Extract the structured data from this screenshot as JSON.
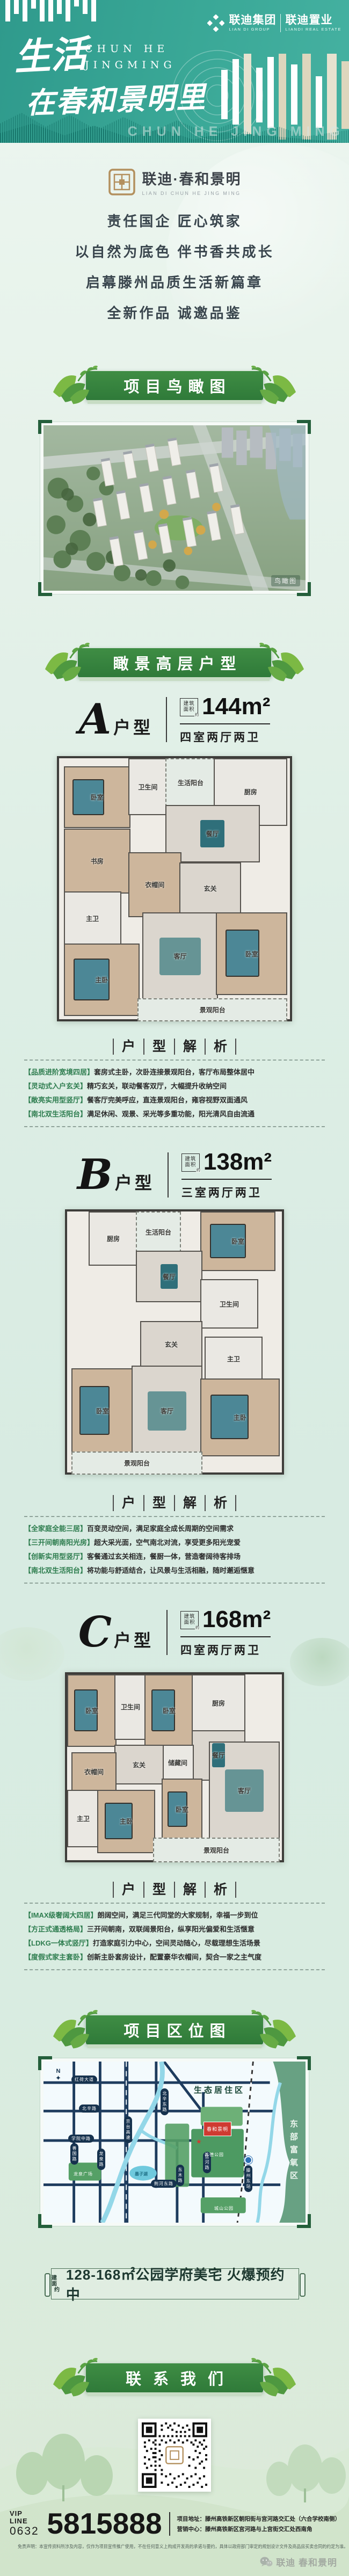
{
  "header": {
    "logo": {
      "group_cn": "联迪集团",
      "group_en": "LIAN DI GROUP",
      "estate_cn": "联迪置业",
      "estate_en": "LIANDI REAL ESTATE"
    },
    "title_line1": "生活",
    "title_line2": "在春和景明里",
    "subtitle_line1": "CHUN HE",
    "subtitle_line2": "JINGMING",
    "watermark": "CHUN HE JING MING"
  },
  "intro": {
    "brand_cn": "联迪·春和景明",
    "brand_en": "LIAN DI   CHUN HE JING MING",
    "line1": "责任国企 匠心筑家",
    "line2": "以自然为底色 伴书香共成长",
    "line3": "启幕滕州品质生活新篇章",
    "line4": "全新作品 诚邀品鉴"
  },
  "sections": {
    "aerial_banner": "项目鸟瞰图",
    "floorplan_banner": "瞰景高层户型",
    "location_banner": "项目区位图",
    "contact_banner": "联系我们"
  },
  "aerial": {
    "watermark": "鸟瞰图"
  },
  "analysis_title": [
    "户",
    "型",
    "解",
    "析"
  ],
  "units": [
    {
      "letter": "A",
      "suffix": "户型",
      "area_box": [
        "建筑",
        "面积"
      ],
      "area_approx": "约",
      "area": "144m²",
      "rooms": "四室两厅两卫",
      "analysis": [
        {
          "tag": "【品质进阶宽境四居】",
          "text": "套房式主卧，次卧连接景观阳台，客厅布局整体居中"
        },
        {
          "tag": "【灵动式入户玄关】",
          "text": "精巧玄关，联动餐客双厅，大幅提升收纳空间"
        },
        {
          "tag": "【敞亮实用型竖厅】",
          "text": "餐客厅完美呼应，直连景观阳台，雍容视野双面通风"
        },
        {
          "tag": "【南北双生活阳台】",
          "text": "满足休闲、观景、采光等多重功能，阳光清风自由流通"
        }
      ],
      "plan": [
        "卧室",
        "卫生间",
        "生活阳台",
        "厨房",
        "餐厅",
        "书房",
        "衣帽间",
        "玄关",
        "主卫",
        "主卧",
        "客厅",
        "卧室",
        "景观阳台"
      ]
    },
    {
      "letter": "B",
      "suffix": "户型",
      "area_box": [
        "建筑",
        "面积"
      ],
      "area_approx": "约",
      "area": "138m²",
      "rooms": "三室两厅两卫",
      "analysis": [
        {
          "tag": "【全家庭全能三居】",
          "text": "百变灵动空间，满足家庭全成长周期的空间需求"
        },
        {
          "tag": "【三开间朝南阳光房】",
          "text": "超大采光面，空气南北对流，享受更多阳光宠爱"
        },
        {
          "tag": "【创新实用型竖厅】",
          "text": "客餐通过玄关相连，餐厨一体，营造奢阔待客排场"
        },
        {
          "tag": "【南北双生活阳台】",
          "text": "将功能与舒适结合，让风景与生活相融，随时邂逅惬意"
        }
      ],
      "plan": [
        "厨房",
        "生活阳台",
        "卧室",
        "餐厅",
        "卫生间",
        "玄关",
        "主卫",
        "卧室",
        "客厅",
        "主卧",
        "景观阳台"
      ]
    },
    {
      "letter": "C",
      "suffix": "户型",
      "area_box": [
        "建筑",
        "面积"
      ],
      "area_approx": "约",
      "area": "168m²",
      "rooms": "四室两厅两卫",
      "analysis": [
        {
          "tag": "【IMAX级奢阔大四居】",
          "text": "朗阔空间，满足三代同堂的大家规制，幸福一步到位"
        },
        {
          "tag": "【方正式通透格局】",
          "text": "三开间朝南，双联阔景阳台，纵享阳光偏爱和生活惬意"
        },
        {
          "tag": "【LDKG一体式竖厅】",
          "text": "打造家庭引力中心，空间灵动随心，尽载理想生活场景"
        },
        {
          "tag": "【度假式家主套卧】",
          "text": "创新主卧套房设计，配置豪华衣帽间，契合一家之主气度"
        }
      ],
      "plan": [
        "卧室",
        "卫生间",
        "卧室",
        "厨房",
        "餐厅",
        "储藏间",
        "玄关",
        "衣帽间",
        "主卫",
        "主卧",
        "卧室",
        "客厅",
        "景观阳台"
      ]
    }
  ],
  "location": {
    "compass": "N",
    "compass_icon": "✦",
    "star_icon": "★",
    "eco_zone": "生态居住区",
    "east_zone": "东部富氧区",
    "project": "春和景明",
    "station": "滕州东站",
    "lake": "墨子湖",
    "roads": [
      "红荷大道",
      "北辛路",
      "学院中路",
      "荆河东路",
      "善国路",
      "龙泉路",
      "京台高速",
      "北辛东路",
      "宫河路",
      "东木路"
    ],
    "parks": [
      "龙泉广场",
      "养德公园",
      "城山公园"
    ]
  },
  "slogan": {
    "prefix1": "建面",
    "prefix2": "约",
    "text": "128-168㎡公园学府美宅 火爆预约中"
  },
  "contact": {
    "vip_label": "VIP LINE",
    "vip_code": "0632",
    "phone": "5815888",
    "address1": "项目地址：滕州高铁新区朝阳街与宫河路交汇处（六合学校南侧）",
    "address2": "营销中心：滕州高铁新区宫河路与上宫街交汇处西南角",
    "disclaimer": "免责声明：本宣传资料所涉及内容，仅作为项目宣传推广使用，不在任何意义上构成开发商的承诺与要约，具体以政府部门审定的规划设计文件及商品房买卖合同的约定为准。",
    "wechat_brand": "联迪 春和景明"
  },
  "colors": {
    "teal": "#38a092",
    "banner_green": "#37813f",
    "accent_gold": "#b3905e",
    "map_red": "#cf3a31"
  }
}
